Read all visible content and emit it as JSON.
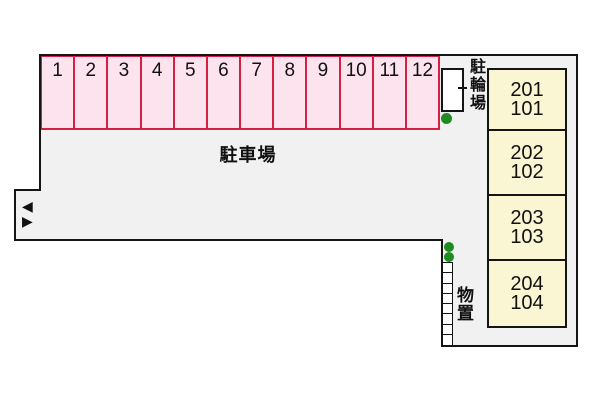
{
  "site": {
    "fill": "#f1f1f1",
    "outline_color": "#141414",
    "labels": {
      "parking_lot": "駐車場",
      "bicycle_parking": "駐輪場",
      "storage": "物置"
    }
  },
  "parking": {
    "stall_fill": "#fce3ed",
    "stall_border": "#d42045",
    "stalls": [
      "1",
      "2",
      "3",
      "4",
      "5",
      "6",
      "7",
      "8",
      "9",
      "10",
      "11",
      "12"
    ]
  },
  "buildings": {
    "fill": "#faf5d2",
    "units": [
      {
        "upper": "201",
        "lower": "101"
      },
      {
        "upper": "202",
        "lower": "102"
      },
      {
        "upper": "203",
        "lower": "103"
      },
      {
        "upper": "204",
        "lower": "104"
      }
    ]
  },
  "markers": {
    "tree_color": "#1e8c1e",
    "arrow_left": "◀",
    "arrow_right": "▶"
  }
}
